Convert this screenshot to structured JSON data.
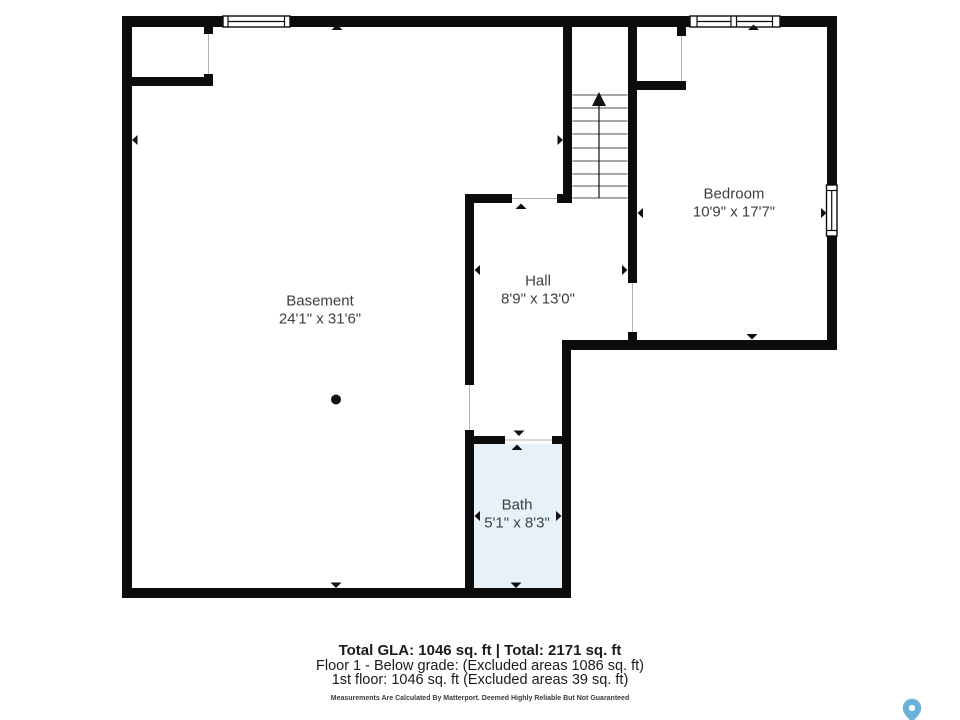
{
  "rooms": {
    "basement": {
      "name": "Basement",
      "dims": "24'1\" x 31'6\""
    },
    "hall": {
      "name": "Hall",
      "dims": "8'9\" x 13'0\""
    },
    "bedroom": {
      "name": "Bedroom",
      "dims": "10'9\" x 17'7\""
    },
    "bath": {
      "name": "Bath",
      "dims": "5'1\" x 8'3\""
    }
  },
  "summary": {
    "totals": "Total GLA: 1046 sq. ft | Total: 2171 sq. ft",
    "floor1": "Floor 1 - Below grade: (Excluded areas 1086 sq. ft)",
    "first_floor": "1st floor: 1046 sq. ft (Excluded areas 39 sq. ft)",
    "disclaimer": "Measurements Are Calculated By Matterport. Deemed Highly Reliable But Not Guaranteed"
  },
  "colors": {
    "wall": "#0c0c0c",
    "bath_fill": "#e7f1fa",
    "label_text": "#3f3f3f",
    "pin_blue": "#66b2d8"
  }
}
